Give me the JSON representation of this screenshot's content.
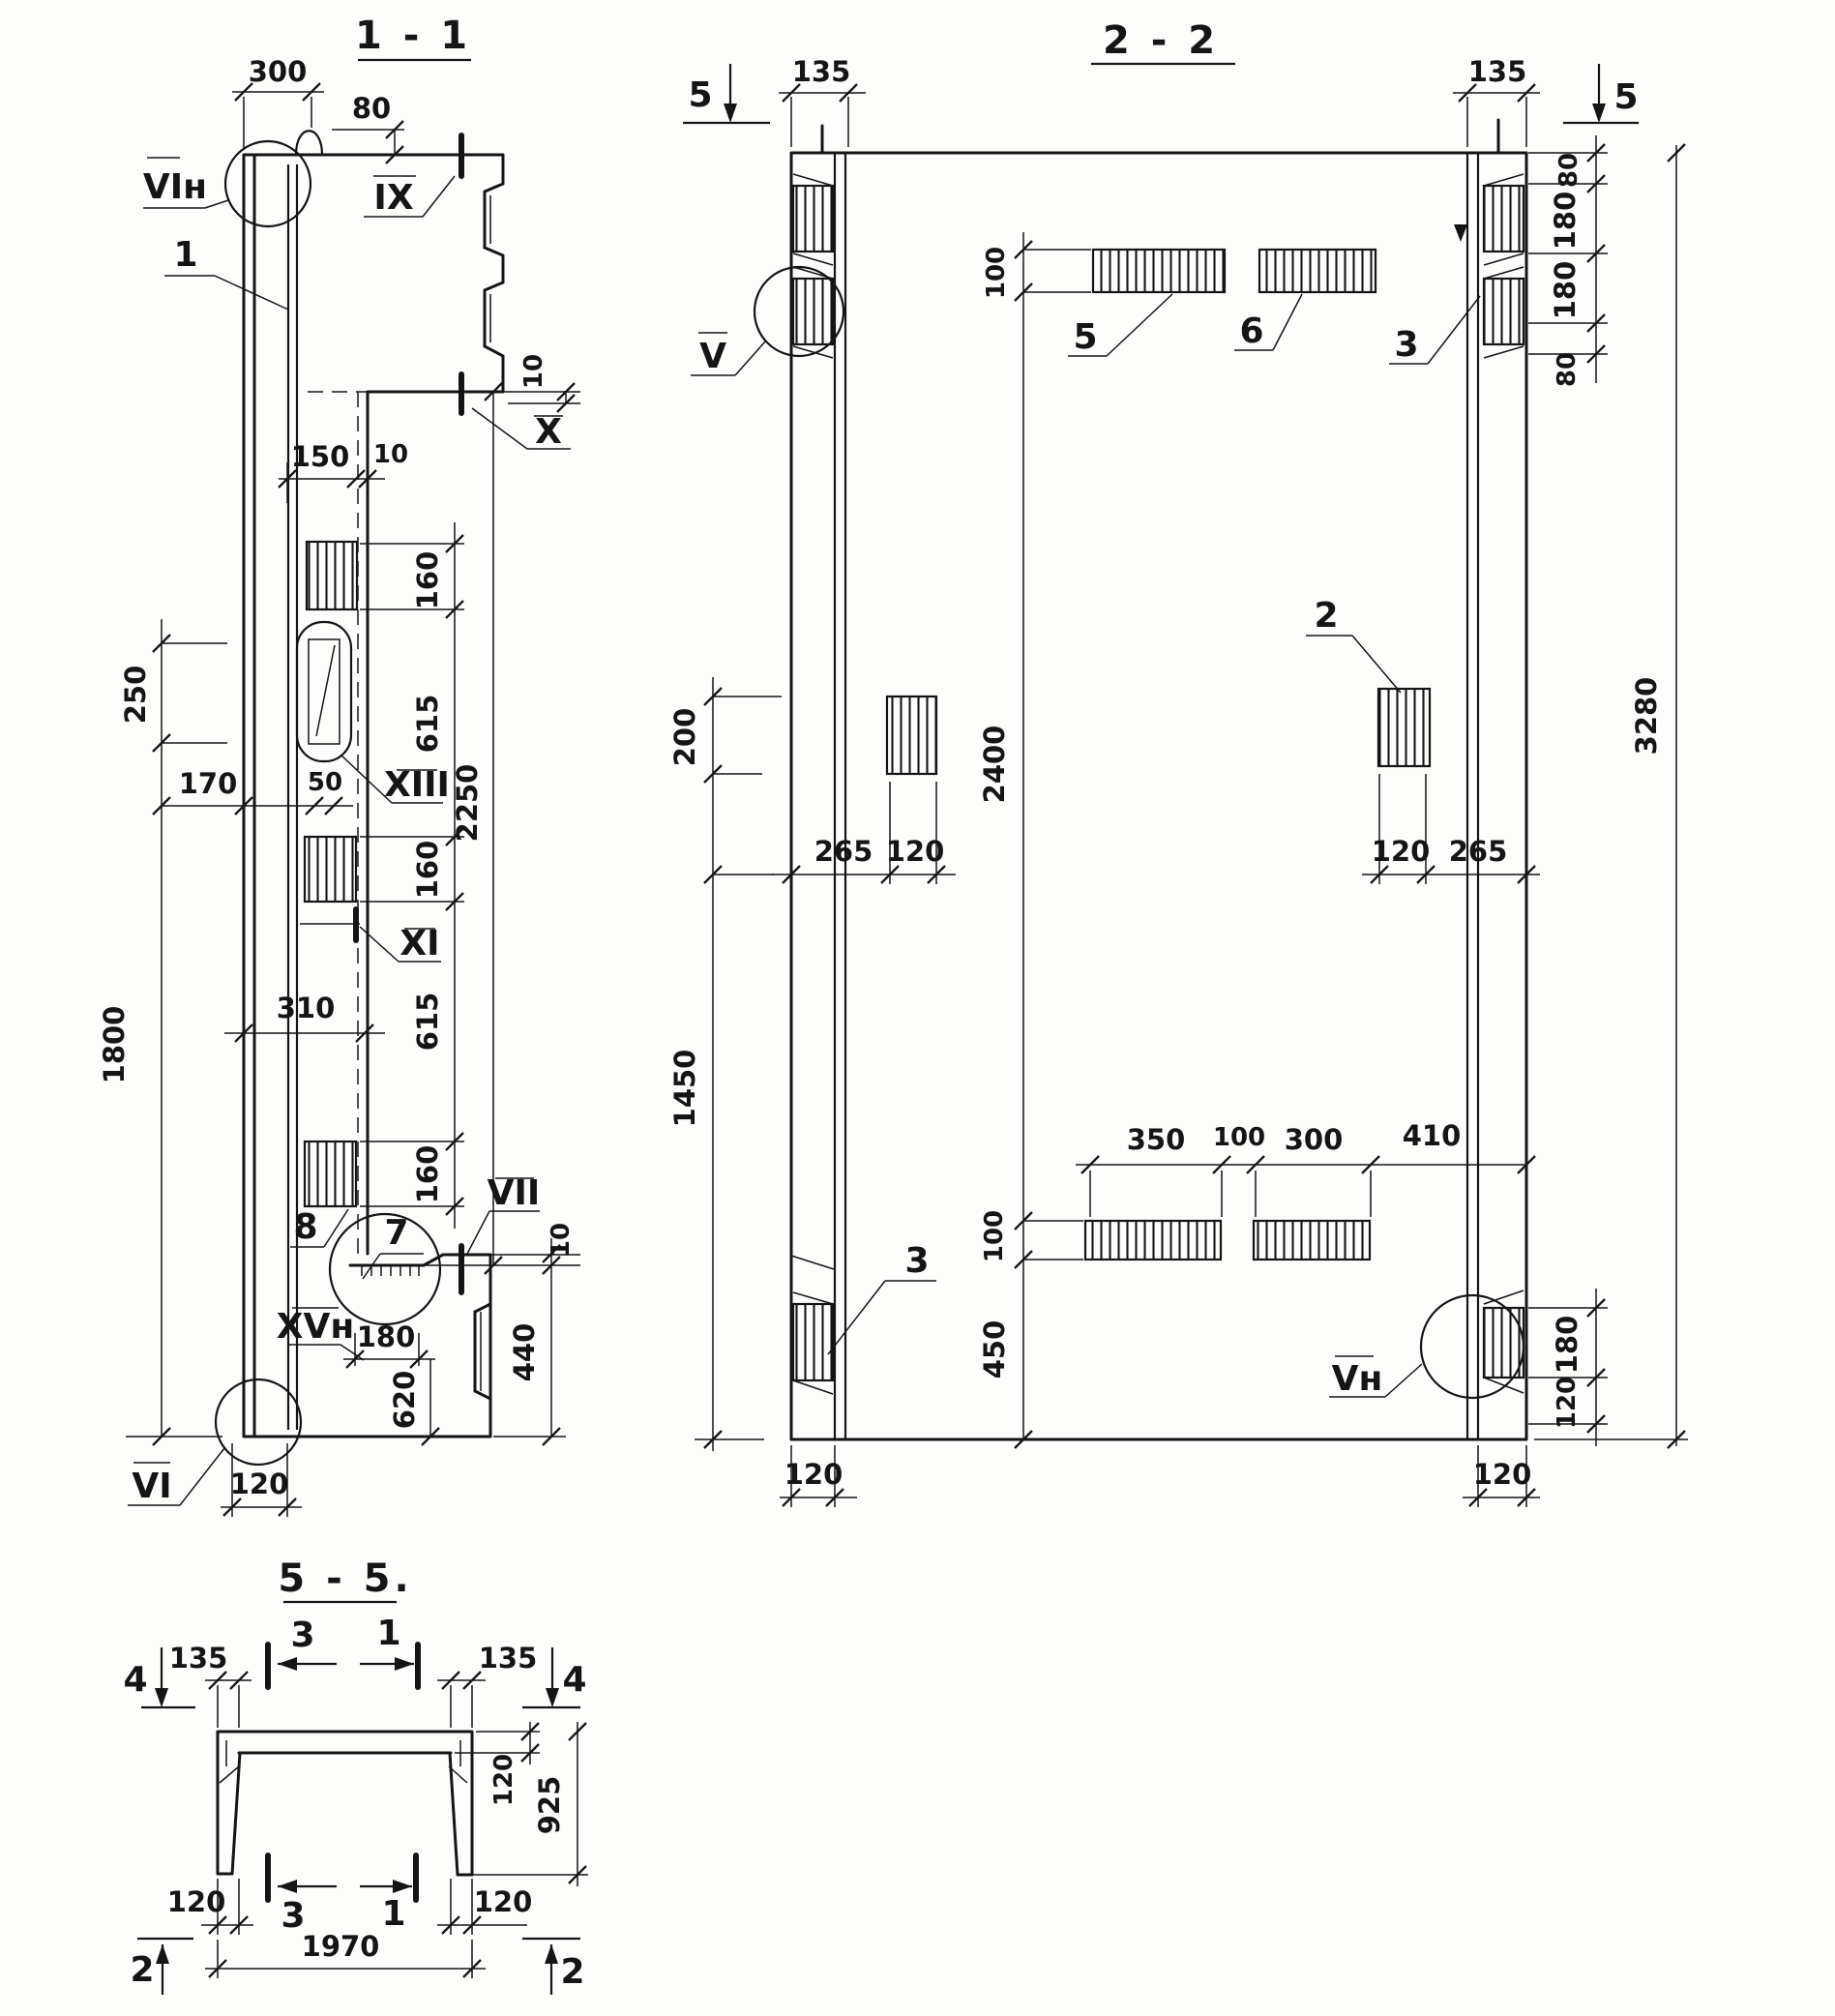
{
  "drawing": {
    "s11": {
      "title": "1 - 1",
      "labels": {
        "vi_n": "VIн",
        "ix": "IX",
        "x": "X",
        "xiii": "XIII",
        "xi": "XI",
        "vii": "VII",
        "xv_n": "XVн",
        "vi": "VI"
      },
      "callouts": {
        "c1": "1",
        "c7": "7",
        "c8": "8"
      },
      "dims": {
        "d300": "300",
        "d80": "80",
        "d10_flange": "10",
        "d150": "150",
        "d10_web": "10",
        "d160_1": "160",
        "d615_1": "615",
        "d160_2": "160",
        "d615_2": "615",
        "d160_3": "160",
        "d2250": "2250",
        "d250": "250",
        "d170": "170",
        "d50": "50",
        "d310": "310",
        "d1800": "1800",
        "d180": "180",
        "d620": "620",
        "d440": "440",
        "d10_console": "10",
        "d120": "120"
      }
    },
    "s22": {
      "title": "2 - 2",
      "labels": {
        "v": "V",
        "v_n": "Vн"
      },
      "callouts": {
        "c2": "2",
        "c3_top": "3",
        "c3_bot": "3",
        "c5": "5",
        "c6": "6"
      },
      "markers": {
        "m5_left": "5",
        "m5_right": "5"
      },
      "dims": {
        "d135_l": "135",
        "d135_r": "135",
        "d80_t1": "80",
        "d180_t1": "180",
        "d180_t2": "180",
        "d80_t2": "80",
        "d3280": "3280",
        "d100_t": "100",
        "d2400": "2400",
        "d100_b": "100",
        "d450": "450",
        "d200": "200",
        "d1450": "1450",
        "d265_l": "265",
        "d120_l": "120",
        "d120_r": "120",
        "d265_r": "265",
        "d350": "350",
        "d100_m": "100",
        "d300": "300",
        "d410": "410",
        "d180_rb": "180",
        "d120_rb": "120",
        "d120_bl": "120",
        "d120_br": "120"
      }
    },
    "s55": {
      "title": "5 - 5.",
      "markers": {
        "m4_l": "4",
        "m4_r": "4",
        "m3_t": "3",
        "m1_t": "1",
        "m3_b": "3",
        "m1_b": "1",
        "m2_l": "2",
        "m2_r": "2"
      },
      "dims": {
        "d135_l": "135",
        "d135_r": "135",
        "d120_t": "120",
        "d925": "925",
        "d120_bl": "120",
        "d120_br": "120",
        "d1970": "1970"
      }
    }
  }
}
